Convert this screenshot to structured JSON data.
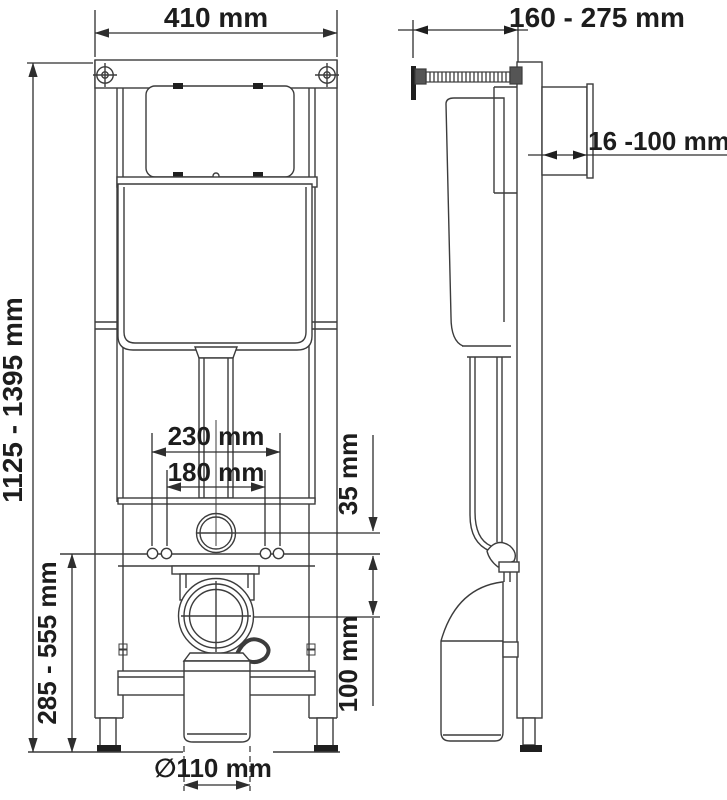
{
  "labels": {
    "frame_width": "410 mm",
    "frame_height_range": "1125 - 1395 mm",
    "anchor_spacing_outer": "230 mm",
    "anchor_spacing_inner": "180 mm",
    "inlet_drop": "35 mm",
    "outlet_drop": "100 mm",
    "outlet_height_range": "285 - 555 mm",
    "outlet_diameter": "∅110 mm",
    "depth_range": "160 - 275 mm",
    "faceplate_range": "16 -100 mm"
  },
  "colors": {
    "background": "#ffffff",
    "line": "#3c3c3c",
    "dimension_line": "#2e2e2e",
    "text": "#1d1d1d",
    "solid_black": "#1f1f1f"
  }
}
